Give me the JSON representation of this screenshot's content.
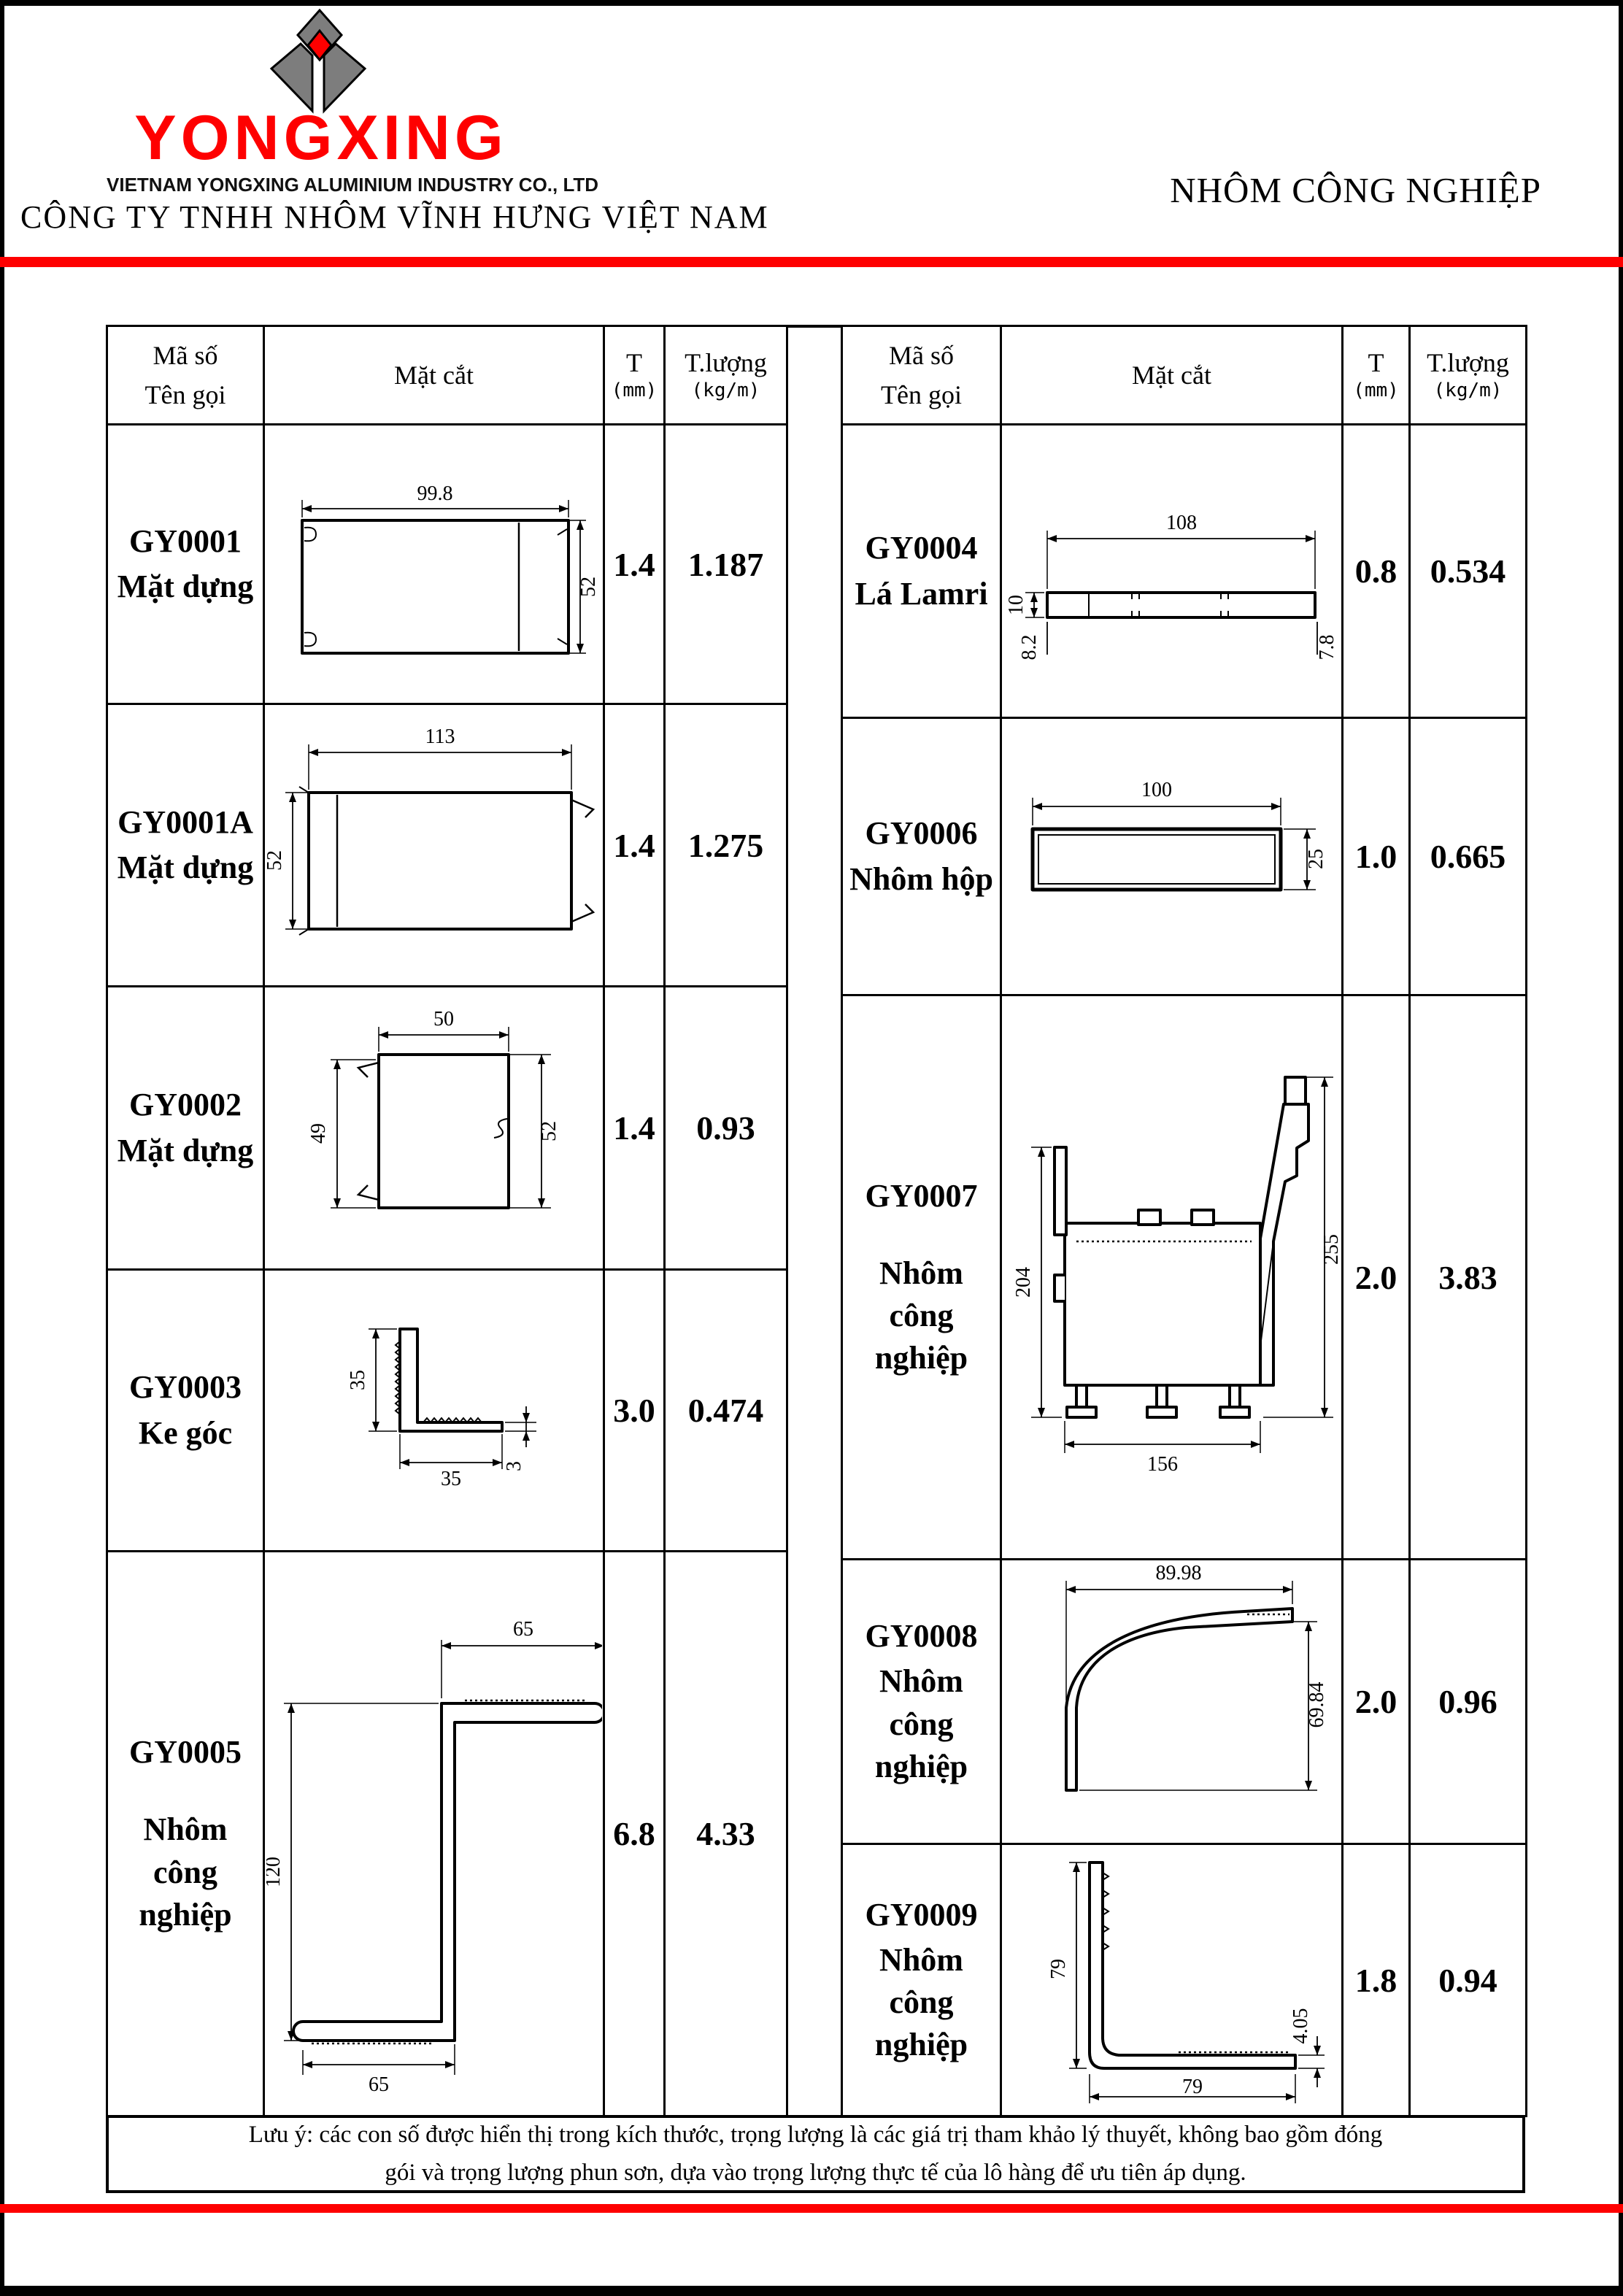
{
  "header": {
    "logo_text": "YONGXING",
    "logo_subtitle": "VIETNAM YONGXING ALUMINIUM INDUSTRY CO., LTD",
    "company_name": "CÔNG TY TNHH NHÔM VĨNH HƯNG VIỆT NAM",
    "category_title": "NHÔM CÔNG NGHIỆP"
  },
  "colors": {
    "accent_red": "#FE0000",
    "logo_gray": "#7D7D7D",
    "line_black": "#000000"
  },
  "table": {
    "headers": {
      "col_code": "Mã số",
      "col_code2": "Tên gọi",
      "col_section": "Mặt cắt",
      "col_t": "T",
      "col_t_unit": "(mm)",
      "col_w": "T.lượng",
      "col_w_unit": "(kg/m)"
    },
    "left_rows": [
      {
        "code": "GY0001",
        "name": "Mặt dựng",
        "t": "1.4",
        "w": "1.187",
        "dims": {
          "top": "99.8",
          "right": "52"
        }
      },
      {
        "code": "GY0001A",
        "name": "Mặt dựng",
        "t": "1.4",
        "w": "1.275",
        "dims": {
          "top": "113",
          "left": "52"
        }
      },
      {
        "code": "GY0002",
        "name": "Mặt dựng",
        "t": "1.4",
        "w": "0.93",
        "dims": {
          "top": "50",
          "left": "49",
          "right": "52"
        }
      },
      {
        "code": "GY0003",
        "name": "Ke góc",
        "t": "3.0",
        "w": "0.474",
        "dims": {
          "left": "35",
          "bottom": "35",
          "right": "3"
        }
      },
      {
        "code": "GY0005",
        "name": "Nhôm công nghiệp",
        "t": "6.8",
        "w": "4.33",
        "dims": {
          "top": "65",
          "left": "120",
          "bottom": "65"
        }
      }
    ],
    "right_rows": [
      {
        "code": "GY0004",
        "name": "Lá Lamri",
        "t": "0.8",
        "w": "0.534",
        "dims": {
          "top": "108",
          "left": "10",
          "left2": "8.2",
          "right": "7.8"
        }
      },
      {
        "code": "GY0006",
        "name": "Nhôm hộp",
        "t": "1.0",
        "w": "0.665",
        "dims": {
          "top": "100",
          "right": "25"
        }
      },
      {
        "code": "GY0007",
        "name": "Nhôm công nghiệp",
        "t": "2.0",
        "w": "3.83",
        "dims": {
          "left": "204",
          "right": "255",
          "bottom": "156"
        }
      },
      {
        "code": "GY0008",
        "name": "Nhôm công nghiệp",
        "t": "2.0",
        "w": "0.96",
        "dims": {
          "top": "89.98",
          "right": "69.84"
        }
      },
      {
        "code": "GY0009",
        "name": "Nhôm công nghiệp",
        "t": "1.8",
        "w": "0.94",
        "dims": {
          "left": "79",
          "bottom": "79",
          "right": "4.05"
        }
      }
    ],
    "note": {
      "line1": "Lưu ý: các con số được hiển thị trong kích thước, trọng lượng là các giá trị tham khảo lý thuyết, không bao gồm đóng",
      "line2": "gói và trọng lượng phun sơn, dựa vào trọng lượng thực tế của lô hàng  để ưu tiên áp dụng."
    }
  }
}
